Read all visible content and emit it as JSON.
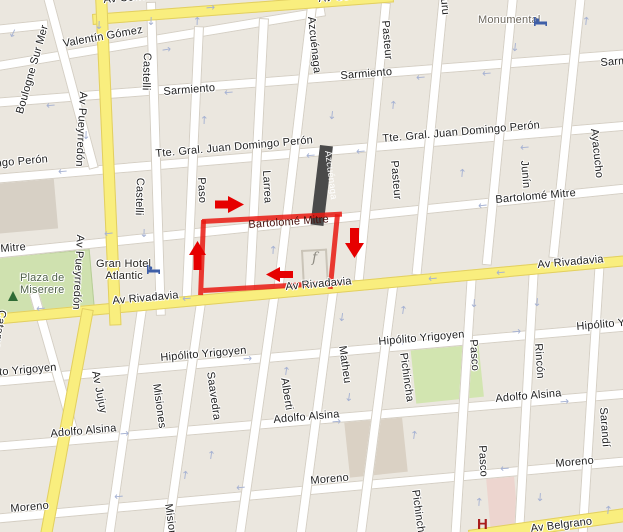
{
  "map": {
    "streets": {
      "corrientes": "Av Corrientes",
      "valentin_gomez": "Valentín Gómez",
      "boulogne_sur_mer": "Boulogne Sur Mer",
      "sarmiento": "Sarmiento",
      "peron": "Tte. Gral. Juan Domingo Perón",
      "mitre": "Bartolomé Mitre",
      "rivadavia": "Av Rivadavia",
      "yrigoyen": "Hipólito Yrigoyen",
      "alsina": "Adolfo Alsina",
      "moreno": "Moreno",
      "belgrano": "Av Belgrano",
      "pueyrredon": "Av Pueyrredón",
      "jujuy": "Av Jujuy",
      "catamarca": "Catamarca",
      "castelli": "Castelli",
      "paso": "Paso",
      "larrea": "Larrea",
      "azcuenaga": "Azcuénaga",
      "pasteur": "Pasteur",
      "uriburu_fragment": "uru",
      "junin": "Junín",
      "ayacucho": "Ayacucho",
      "misiones": "Misiones",
      "saavedra": "Saavedra",
      "alberti": "Alberti",
      "matheu": "Matheu",
      "pichincha": "Pichincha",
      "pasco": "Pasco",
      "rincon": "Rincón",
      "sarandi": "Sarandí"
    },
    "pois": {
      "park_line1": "Plaza de",
      "park_line2": "Miserere",
      "hotel_line1": "Gran Hotel",
      "hotel_line2": "Atlantic",
      "monumental": "Monumental",
      "hospital_marker": "H",
      "poi_glyph": "f"
    },
    "colors": {
      "route_red": "#e91912",
      "arrow_red": "#e60000",
      "avenue_yellow": "#f9ee7e",
      "park_green": "#cfe1af",
      "closed_bar_dark": "#4a4a4a",
      "block_beige": "#ebe7df",
      "building_gray": "#d7d0c5",
      "hospital_pink": "#edd5cf",
      "oneway_arrow_blue": "#a6b2d3"
    }
  }
}
